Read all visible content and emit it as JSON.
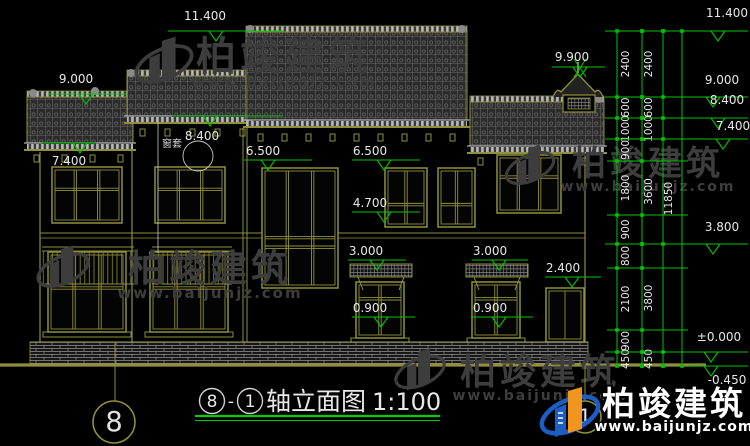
{
  "canvas": {
    "width": 750,
    "height": 446,
    "background": "#000000"
  },
  "colors": {
    "building_line": "#8f8f3c",
    "cad_green": "#00c300",
    "dim_text": "#e8e8e8",
    "watermark_gray": "#3d3d3d",
    "title_underline": "#00cc00",
    "logo_blue": "#1b5fc6",
    "logo_orange": "#f0961e"
  },
  "title": {
    "axis_start": "8",
    "separator": "-",
    "axis_end": "1",
    "name": "轴立面图",
    "scale": "1:100"
  },
  "axis_bubbles": [
    {
      "label": "8",
      "cx": 114,
      "cy": 422,
      "r": 21,
      "line": {
        "x": 115,
        "y1": 343,
        "y2": 401
      }
    },
    {
      "label": "1",
      "cx": 585,
      "cy": 417,
      "r": 16,
      "line": {
        "x": 585,
        "y1": 366,
        "y2": 401
      }
    }
  ],
  "elevation_markers": [
    {
      "label": "11.400",
      "cx": 205,
      "ty": 20,
      "ly": 31,
      "x1": 168,
      "x2": 284,
      "tip": 216
    },
    {
      "label": "9.000",
      "cx": 76,
      "ty": 83,
      "ly": 94,
      "x1": 48,
      "x2": 128,
      "tip": 86
    },
    {
      "label": "8.400",
      "cx": 202,
      "ty": 140,
      "ly": 116,
      "x1": 172,
      "x2": 283,
      "tip": 210
    },
    {
      "label": "7.400",
      "cx": 69,
      "ty": 165,
      "ly": 143,
      "x1": 42,
      "x2": 96,
      "tip": 80
    },
    {
      "label": "6.500",
      "cx": 263,
      "ty": 155,
      "ly": 160,
      "x1": 244,
      "x2": 312,
      "tip": 268
    },
    {
      "label": "6.500",
      "cx": 370,
      "ty": 155,
      "ly": 160,
      "x1": 352,
      "x2": 420,
      "tip": 384
    },
    {
      "label": "4.700",
      "cx": 370,
      "ty": 207,
      "ly": 212,
      "x1": 352,
      "x2": 420,
      "tip": 384
    },
    {
      "label": "3.000",
      "cx": 366,
      "ty": 255,
      "ly": 260,
      "x1": 348,
      "x2": 406,
      "tip": 377
    },
    {
      "label": "3.000",
      "cx": 490,
      "ty": 255,
      "ly": 260,
      "x1": 472,
      "x2": 528,
      "tip": 499
    },
    {
      "label": "2.400",
      "cx": 563,
      "ty": 272,
      "ly": 277,
      "x1": 545,
      "x2": 601,
      "tip": 572
    },
    {
      "label": "0.900",
      "cx": 370,
      "ty": 312,
      "ly": 317,
      "x1": 352,
      "x2": 415,
      "tip": 381
    },
    {
      "label": "0.900",
      "cx": 490,
      "ty": 312,
      "ly": 317,
      "x1": 472,
      "x2": 533,
      "tip": 499
    },
    {
      "label": "9.900",
      "cx": 572,
      "ty": 61,
      "ly": 67,
      "x1": 552,
      "x2": 605,
      "tip": 580,
      "bowtie": true
    },
    {
      "label": "11.400",
      "cx": 727,
      "ty": 17,
      "ly": 31,
      "x1": 605,
      "x2": 748,
      "tip": 718
    },
    {
      "label": "9.000",
      "cx": 722,
      "ty": 84,
      "ly": 97,
      "x1": 605,
      "x2": 748,
      "tip": 713
    },
    {
      "label": "8.400",
      "cx": 727,
      "ty": 104,
      "ly": 118,
      "x1": 605,
      "x2": 748,
      "tip": 718
    },
    {
      "label": "7.400",
      "cx": 733,
      "ty": 130,
      "ly": 139,
      "x1": 605,
      "x2": 748,
      "tip": 723
    },
    {
      "label": "3.800",
      "cx": 722,
      "ty": 231,
      "ly": 244,
      "x1": 605,
      "x2": 748,
      "tip": 713
    },
    {
      "label": "±0.000",
      "cx": 719,
      "ty": 341,
      "ly": 352,
      "x1": 605,
      "x2": 748,
      "tip": 711
    },
    {
      "label": "-0.450",
      "cx": 727,
      "ty": 384,
      "ly": 366,
      "x1": 688,
      "x2": 748,
      "tip": 711
    }
  ],
  "dimension_chain": {
    "verticals": [
      617,
      642,
      663,
      682
    ],
    "top": 31,
    "bottom": 366,
    "minor_lines": [
      161,
      215,
      268,
      330
    ],
    "minor_x1": 607,
    "minor_x2": 688,
    "columns": [
      {
        "cx": 629,
        "boundaries": [
          31,
          97,
          118,
          139,
          161,
          215,
          244,
          268,
          330,
          352,
          366
        ],
        "labels": [
          "2400",
          "600",
          "1000",
          "900",
          "1800",
          "900",
          "800",
          "2100",
          "900",
          "450"
        ]
      },
      {
        "cx": 652,
        "boundaries": [
          31,
          97,
          118,
          139,
          244,
          352,
          366
        ],
        "labels": [
          "2400",
          "600",
          "1000",
          "3600",
          "3800",
          "450"
        ]
      },
      {
        "cx": 672,
        "boundaries": [
          31,
          366
        ],
        "labels": [
          "11850"
        ]
      }
    ]
  },
  "annotations": [
    {
      "text": "窗套",
      "x": 172,
      "y": 147
    }
  ],
  "detail_circle": {
    "cx": 198,
    "cy": 156,
    "r": 15,
    "leader": {
      "x": 158,
      "y1": 120,
      "y2": 253
    }
  },
  "watermarks": [
    {
      "big": "柏竣建筑",
      "small": "www.baijunjz.com",
      "x": 284,
      "y": 70,
      "small_y": 87,
      "big_size": 40,
      "small_size": 15,
      "logo": {
        "cx": 164,
        "cy": 64,
        "s": 1.05
      }
    },
    {
      "big": "柏竣建筑",
      "small": "www.baijunjz.com",
      "x": 648,
      "y": 175,
      "small_y": 191,
      "big_size": 34,
      "small_size": 14,
      "logo": {
        "cx": 530,
        "cy": 168,
        "s": 0.9
      }
    },
    {
      "big": "柏竣建筑",
      "small": "www.baijunjz.com",
      "x": 210,
      "y": 281,
      "small_y": 298,
      "big_size": 37,
      "small_size": 15,
      "logo": {
        "cx": 63,
        "cy": 270,
        "s": 0.95
      }
    },
    {
      "big": "柏竣建筑",
      "small": "www.baijunjz.com",
      "x": 540,
      "y": 384,
      "small_y": 400,
      "big_size": 36,
      "small_size": 14,
      "logo": {
        "cx": 420,
        "cy": 372,
        "s": 0.92
      }
    }
  ],
  "brand": {
    "big": "柏竣建筑",
    "small": "www.baijunjz.com",
    "x": 674,
    "y": 415,
    "small_y": 431,
    "big_size": 33,
    "small_size": 14,
    "logo": {
      "cx": 570,
      "cy": 415,
      "s": 1
    }
  }
}
